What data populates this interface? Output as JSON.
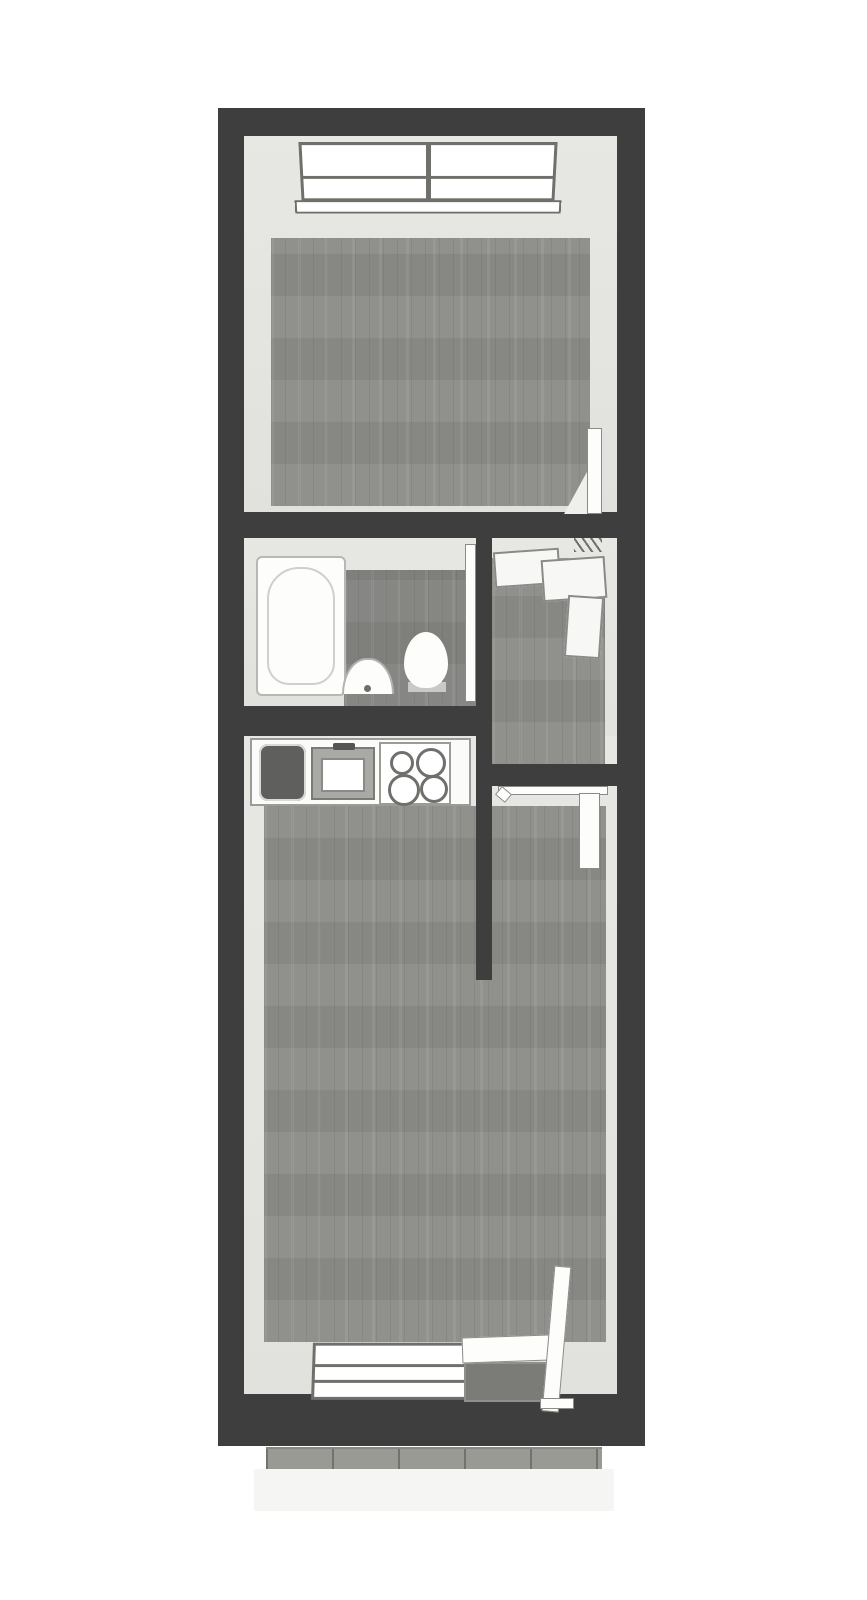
{
  "scene": {
    "type": "3d-top-view-floor-plan",
    "title": "Apartment floor plan (3D top view)",
    "background_color": "#ffffff"
  },
  "palette": {
    "exterior_wall": "#3e3e3e",
    "interior_wall_face": "#e4e4e0",
    "wood_floor": "#8c8c88",
    "bathroom_floor": "#838380",
    "fixture_white": "#fcfcfa",
    "fixture_outline": "#8f8f8b",
    "kitchen_basin_dark": "#5f5f5d",
    "glass_pane_dark": "#7b7b77",
    "deck_planks": "#9a9a94",
    "deck_apron": "#f5f5f3"
  },
  "rooms": {
    "top_room": {
      "label": "Room (top)",
      "fixtures": [
        "double-casement-window-top-wall",
        "open-door-bottom-right"
      ]
    },
    "bathroom": {
      "label": "Bathroom",
      "fixtures": [
        "bathtub-left",
        "washbasin-bottom-wall",
        "toilet-right",
        "open-door-right-wall"
      ]
    },
    "hallway": {
      "label": "Entry hall",
      "fixtures": [
        "wardrobe-shelves-top-right",
        "open-door-to-living-room"
      ]
    },
    "living_kitchen": {
      "label": "Living room with kitchenette",
      "fixtures": [
        "kitchen-counter-top-wall",
        "dark-basin",
        "sink-with-faucet",
        "cooktop-4-burners",
        "window-bottom-wall",
        "glass-door-bottom-right"
      ]
    },
    "balcony": {
      "label": "Balcony deck (below bottom wall)",
      "fixtures": [
        "wood-plank-deck",
        "light-apron"
      ]
    }
  },
  "counts": {
    "rooms": 4,
    "doors": 4,
    "windows": 2,
    "cooktop_burners": 4
  }
}
